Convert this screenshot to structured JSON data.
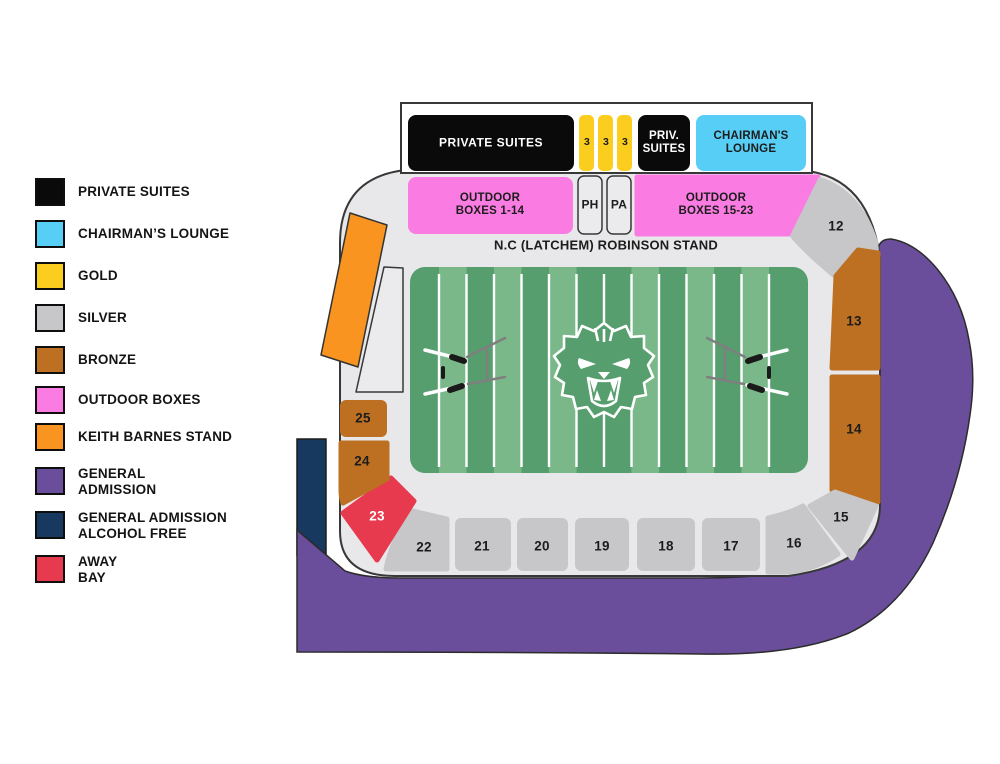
{
  "legend": {
    "items": [
      {
        "label": "PRIVATE SUITES",
        "color": "#0a0a0a"
      },
      {
        "label": "CHAIRMAN’S LOUNGE",
        "color": "#57cef5"
      },
      {
        "label": "GOLD",
        "color": "#fbcd1e"
      },
      {
        "label": "SILVER",
        "color": "#c7c7c9"
      },
      {
        "label": "BRONZE",
        "color": "#bd7022"
      },
      {
        "label": "OUTDOOR BOXES",
        "color": "#fa7ce2"
      },
      {
        "label": "KEITH BARNES STAND",
        "color": "#f8941f"
      },
      {
        "label": "GENERAL\nADMISSION",
        "color": "#6a4e9b"
      },
      {
        "label": "GENERAL ADMISSION\nALCOHOL FREE",
        "color": "#17395f"
      },
      {
        "label": "AWAY\nBAY",
        "color": "#e73a4e"
      }
    ]
  },
  "map": {
    "top_row": {
      "private_suites": "PRIVATE SUITES",
      "gold": [
        "3",
        "3",
        "3"
      ],
      "priv_suites": "PRIV.\nSUITES",
      "chairmans_lounge": "CHAIRMAN'S\nLOUNGE"
    },
    "boxes_row": {
      "outdoor_left": "OUTDOOR\nBOXES 1-14",
      "ph": "PH",
      "pa": "PA",
      "outdoor_right": "OUTDOOR\nBOXES 15-23"
    },
    "stand_name": "N.C (LATCHEM) ROBINSON STAND",
    "sections": {
      "s12": "12",
      "s13": "13",
      "s14": "14",
      "s15": "15",
      "s16": "16",
      "s17": "17",
      "s18": "18",
      "s19": "19",
      "s20": "20",
      "s21": "21",
      "s22": "22",
      "s23": "23",
      "s24": "24",
      "s25": "25"
    }
  },
  "colors": {
    "black": "#0a0a0a",
    "cyan": "#57cef5",
    "gold": "#fbcd1e",
    "silver": "#c7c7c9",
    "bronze": "#bd7022",
    "pink": "#fa7ce2",
    "orange": "#f8941f",
    "purple": "#6a4e9b",
    "navy": "#17395f",
    "red": "#e73a4e",
    "bowl": "#e8e8ea",
    "box_gray": "#ebebed",
    "field_dark": "#569e6e",
    "field_light": "#7ab889",
    "white": "#ffffff",
    "stroke": "#3a3a3a"
  }
}
